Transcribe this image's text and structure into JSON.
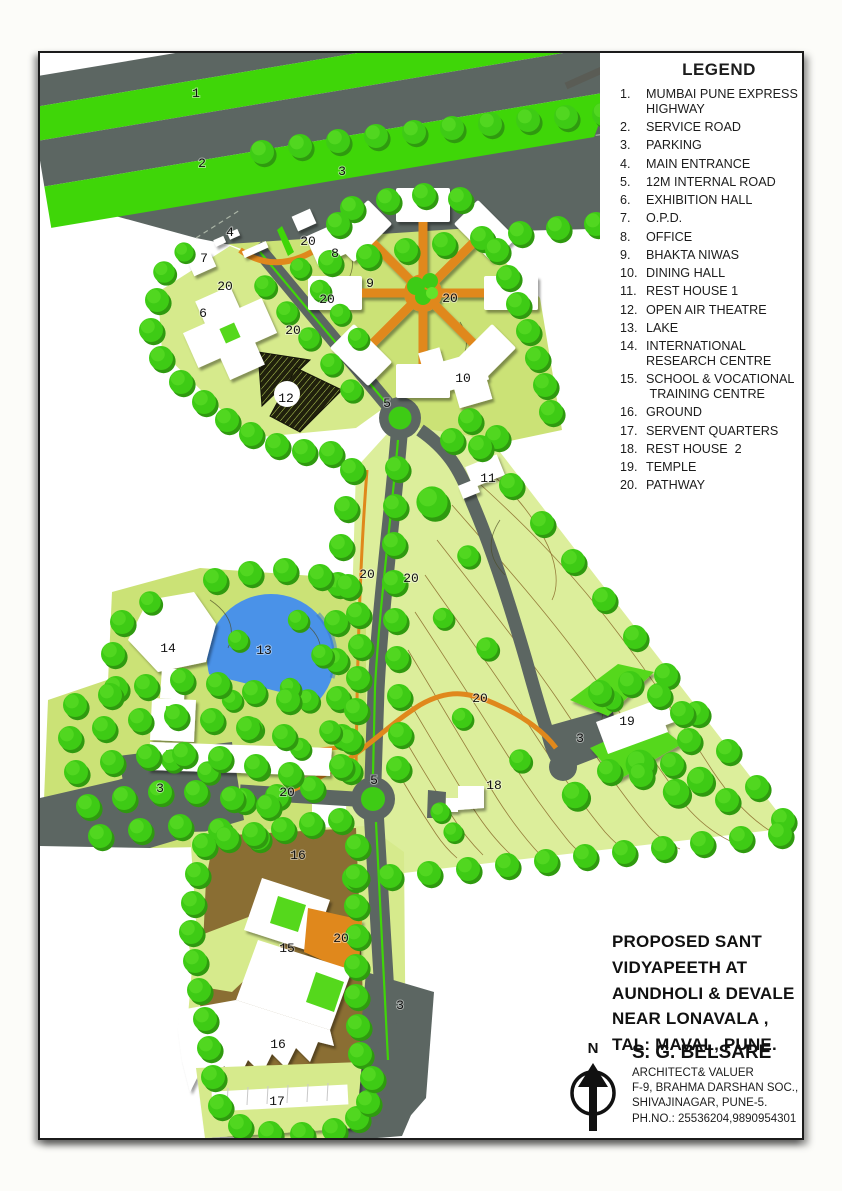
{
  "colors": {
    "highway_green": "#3fd608",
    "road_gray": "#5c6662",
    "site_green": "#cbe276",
    "site_green2": "#d6ea8c",
    "terrain_yellow": "#dcee9b",
    "tree_green": "#3ecb15",
    "tree_dark": "#2f9a0f",
    "lake_blue": "#4a92e8",
    "ground_brown": "#8a6e33",
    "pathway_orange": "#e0881c",
    "courtyard_green": "#55d81a",
    "contour_brown": "#8a6a2a"
  },
  "legend": {
    "heading": "LEGEND",
    "items": [
      {
        "n": "1.",
        "label": "MUMBAI PUNE EXPRESS\nHIGHWAY"
      },
      {
        "n": "2.",
        "label": "SERVICE ROAD"
      },
      {
        "n": "3.",
        "label": "PARKING"
      },
      {
        "n": "4.",
        "label": "MAIN ENTRANCE"
      },
      {
        "n": "5.",
        "label": "12M INTERNAL ROAD"
      },
      {
        "n": "6.",
        "label": "EXHIBITION HALL"
      },
      {
        "n": "7.",
        "label": "O.P.D."
      },
      {
        "n": "8.",
        "label": "OFFICE"
      },
      {
        "n": "9.",
        "label": "BHAKTA NIWAS"
      },
      {
        "n": "10.",
        "label": "DINING HALL"
      },
      {
        "n": "11.",
        "label": "REST HOUSE 1"
      },
      {
        "n": "12.",
        "label": "OPEN AIR THEATRE"
      },
      {
        "n": "13.",
        "label": "LAKE"
      },
      {
        "n": "14.",
        "label": "INTERNATIONAL\nRESEARCH CENTRE"
      },
      {
        "n": "15.",
        "label": "SCHOOL & VOCATIONAL\n TRAINING CENTRE"
      },
      {
        "n": "16.",
        "label": "GROUND"
      },
      {
        "n": "17.",
        "label": "SERVENT QUARTERS"
      },
      {
        "n": "18.",
        "label": "REST HOUSE  2"
      },
      {
        "n": "19.",
        "label": "TEMPLE"
      },
      {
        "n": "20.",
        "label": "PATHWAY"
      }
    ]
  },
  "title_block": {
    "text": "PROPOSED SANT\nVIDYAPEETH AT\nAUNDHOLI & DEVALE\nNEAR LONAVALA ,\nTAL: MAVAL, PUNE."
  },
  "architect": {
    "north_label": "N",
    "name": "S. G. BELSARE",
    "line1": "ARCHITECT& VALUER",
    "line2": "F-9, BRAHMA DARSHAN SOC.,",
    "line3": "SHIVAJINAGAR, PUNE-5.",
    "line4": "PH.NO.: 25536204,9890954301"
  },
  "map": {
    "markers": {
      "highway": "1",
      "service_road": "2",
      "parking": "3",
      "main_entrance": "4",
      "internal_road": "5",
      "exhibition_hall": "6",
      "opd": "7",
      "office": "8",
      "bhakta_niwas": "9",
      "dining_hall": "10",
      "rest_house_1": "11",
      "open_air_theatre": "12",
      "lake": "13",
      "research_centre": "14",
      "school": "15",
      "ground": "16",
      "servent_quarters": "17",
      "rest_house_2": "18",
      "temple": "19",
      "pathway": "20"
    }
  }
}
